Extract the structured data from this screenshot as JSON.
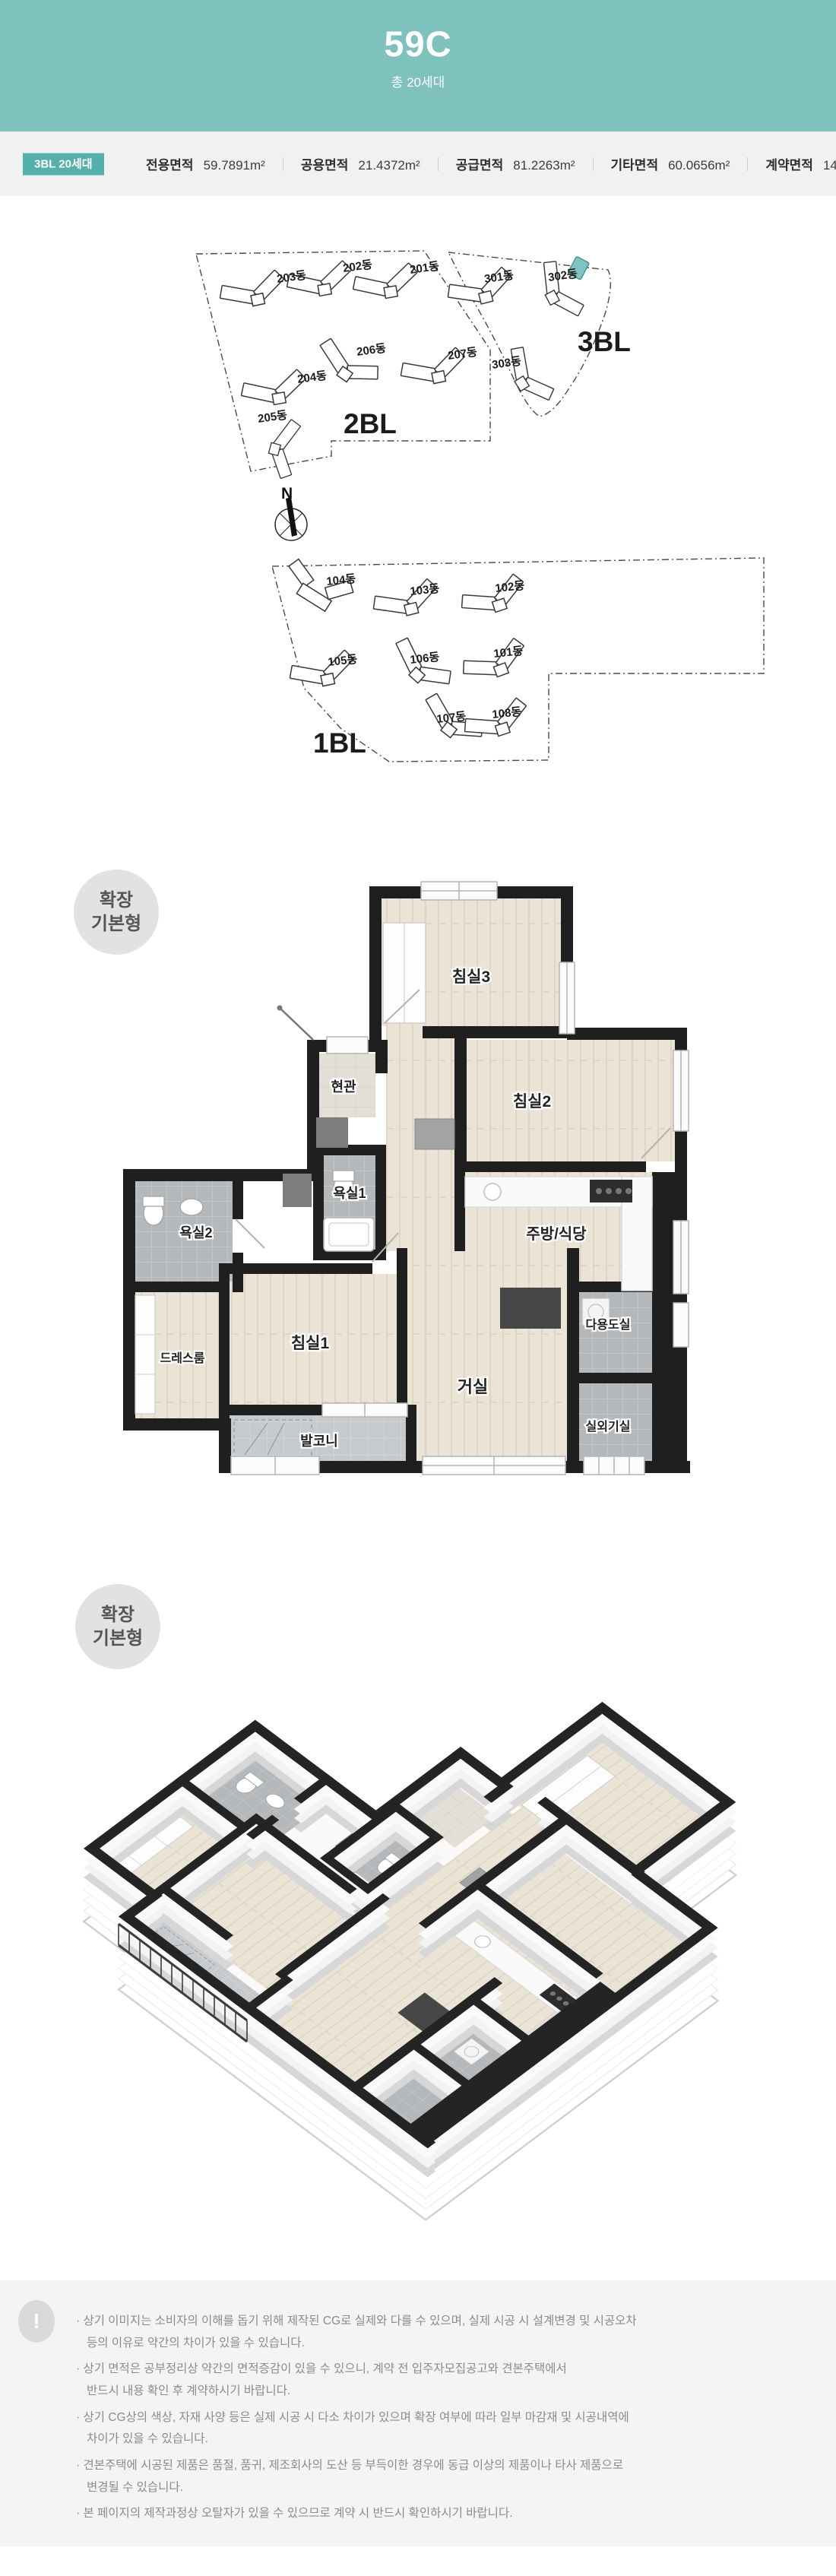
{
  "header": {
    "unit_code": "59C",
    "total_units": "총 20세대"
  },
  "area_info": {
    "badge": "3BL 20세대",
    "items": [
      {
        "label": "전용면적",
        "value": "59.7891m²"
      },
      {
        "label": "공용면적",
        "value": "21.4372m²"
      },
      {
        "label": "공급면적",
        "value": "81.2263m²"
      },
      {
        "label": "기타면적",
        "value": "60.0656m²"
      },
      {
        "label": "계약면적",
        "value": "141.2919m²"
      }
    ]
  },
  "site_plan": {
    "compass_label": "N",
    "bl1": {
      "label": "1BL",
      "buildings": [
        "101동",
        "102동",
        "103동",
        "104동",
        "105동",
        "106동",
        "107동",
        "108동"
      ]
    },
    "bl2": {
      "label": "2BL",
      "buildings": [
        "201동",
        "202동",
        "203동",
        "204동",
        "205동",
        "206동",
        "207동"
      ]
    },
    "bl3": {
      "label": "3BL",
      "buildings": [
        "301동",
        "302동",
        "303동"
      ],
      "highlight_color": "#7fc4c0"
    }
  },
  "floor_plan": {
    "badge_line1": "확장",
    "badge_line2": "기본형",
    "rooms": [
      {
        "label": "침실3"
      },
      {
        "label": "현관"
      },
      {
        "label": "침실2"
      },
      {
        "label": "욕실1"
      },
      {
        "label": "욕실2"
      },
      {
        "label": "주방/식당"
      },
      {
        "label": "다용도실"
      },
      {
        "label": "드레스룸"
      },
      {
        "label": "침실1"
      },
      {
        "label": "거실"
      },
      {
        "label": "실외기실"
      },
      {
        "label": "발코니"
      }
    ]
  },
  "iso_view": {
    "badge_line1": "확장",
    "badge_line2": "기본형"
  },
  "notes": {
    "icon": "!",
    "items": [
      "· 상기 이미지는 소비자의 이해를 돕기 위해 제작된 CG로 실제와 다를 수 있으며, 실제 시공 시 설계변경 및 시공오차\n등의 이유로 약간의 차이가 있을 수 있습니다.",
      "· 상기 면적은 공부정리상 약간의 면적증감이 있을 수 있으니, 계약 전 입주자모집공고와 견본주택에서\n반드시 내용 확인 후 계약하시기 바랍니다.",
      "· 상기 CG상의 색상, 자재 사양 등은 실제 시공 시 다소 차이가 있으며 확장 여부에 따라 일부 마감재 및 시공내역에\n차이가 있을 수 있습니다.",
      "· 견본주택에 시공된 제품은 품절, 품귀, 제조회사의 도산 등 부득이한 경우에 동급 이상의 제품이나 타사 제품으로\n변경될 수 있습니다.",
      "· 본 페이지의 제작과정상 오탈자가 있을 수 있으므로 계약 시 반드시 확인하시기 바랍니다."
    ]
  },
  "colors": {
    "header_teal": "#7fc1bd",
    "badge_teal": "#55afab",
    "highlight_teal": "#7fc4c0",
    "wall": "#1f1f1f"
  }
}
